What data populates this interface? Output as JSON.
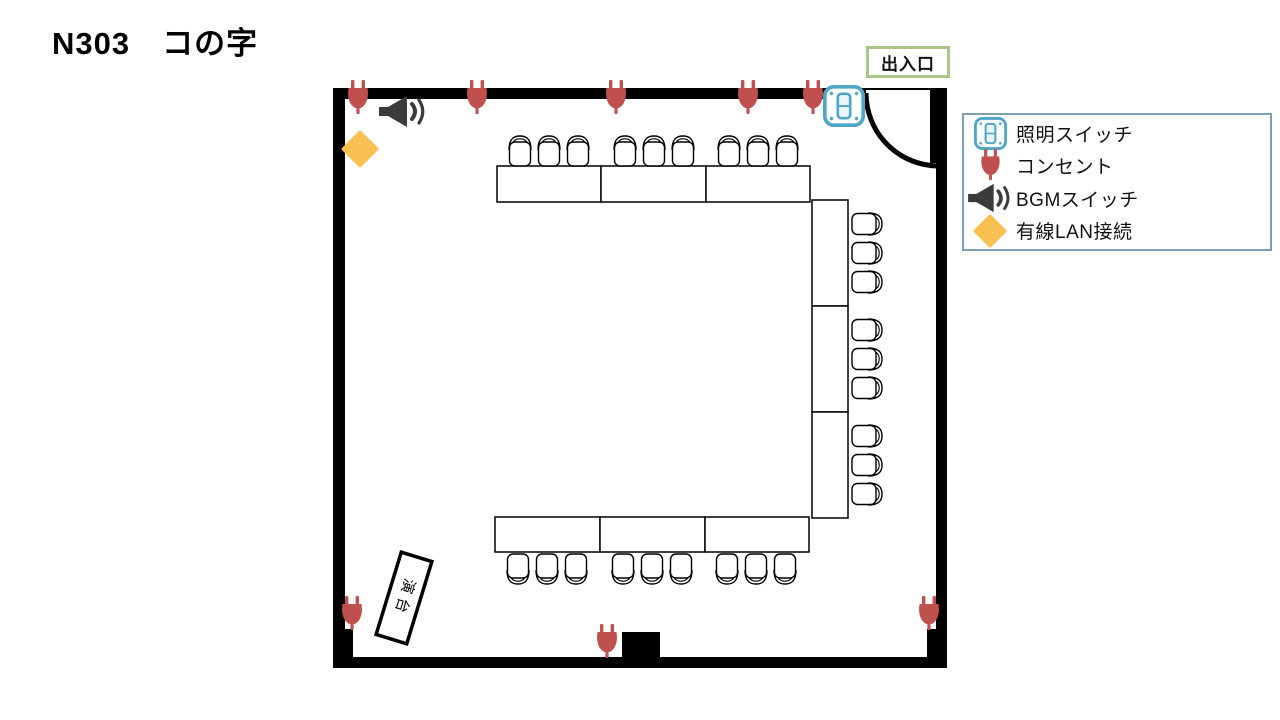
{
  "title": "N303　コの字",
  "door": {
    "label": "出入口"
  },
  "podium": {
    "label": "演台"
  },
  "legend": {
    "items": [
      {
        "icon": "light-switch-icon",
        "label": "照明スイッチ"
      },
      {
        "icon": "outlet-icon",
        "label": "コンセント"
      },
      {
        "icon": "bgm-switch-icon",
        "label": "BGMスイッチ"
      },
      {
        "icon": "wired-lan-icon",
        "label": "有線LAN接続"
      }
    ]
  },
  "colors": {
    "wall": "#000000",
    "outlet_red": "#C0504D",
    "lan_yellow": "#F8C050",
    "switch_blue": "#4FA6C6",
    "speaker_gray": "#3B3B3B",
    "legend_border": "#7C9FB5",
    "entrance_border": "#A9C687"
  },
  "plan": {
    "tables": [
      {
        "x": 497,
        "y": 166,
        "w": 104,
        "h": 36
      },
      {
        "x": 601,
        "y": 166,
        "w": 105,
        "h": 36
      },
      {
        "x": 706,
        "y": 166,
        "w": 104,
        "h": 36
      },
      {
        "x": 812,
        "y": 200,
        "w": 36,
        "h": 106
      },
      {
        "x": 812,
        "y": 306,
        "w": 36,
        "h": 106
      },
      {
        "x": 812,
        "y": 412,
        "w": 36,
        "h": 106
      },
      {
        "x": 495,
        "y": 517,
        "w": 105,
        "h": 35
      },
      {
        "x": 600,
        "y": 517,
        "w": 105,
        "h": 35
      },
      {
        "x": 705,
        "y": 517,
        "w": 104,
        "h": 35
      }
    ],
    "chairs": [
      {
        "x": 506,
        "y": 134,
        "rot": 0
      },
      {
        "x": 535,
        "y": 134,
        "rot": 0
      },
      {
        "x": 564,
        "y": 134,
        "rot": 0
      },
      {
        "x": 611,
        "y": 134,
        "rot": 0
      },
      {
        "x": 640,
        "y": 134,
        "rot": 0
      },
      {
        "x": 669,
        "y": 134,
        "rot": 0
      },
      {
        "x": 715,
        "y": 134,
        "rot": 0
      },
      {
        "x": 744,
        "y": 134,
        "rot": 0
      },
      {
        "x": 773,
        "y": 134,
        "rot": 0
      },
      {
        "x": 853,
        "y": 207,
        "rot": 90
      },
      {
        "x": 853,
        "y": 236,
        "rot": 90
      },
      {
        "x": 853,
        "y": 265,
        "rot": 90
      },
      {
        "x": 853,
        "y": 313,
        "rot": 90
      },
      {
        "x": 853,
        "y": 342,
        "rot": 90
      },
      {
        "x": 853,
        "y": 371,
        "rot": 90
      },
      {
        "x": 853,
        "y": 419,
        "rot": 90
      },
      {
        "x": 853,
        "y": 448,
        "rot": 90
      },
      {
        "x": 853,
        "y": 477,
        "rot": 90
      },
      {
        "x": 504,
        "y": 552,
        "rot": 180
      },
      {
        "x": 533,
        "y": 552,
        "rot": 180
      },
      {
        "x": 562,
        "y": 552,
        "rot": 180
      },
      {
        "x": 609,
        "y": 552,
        "rot": 180
      },
      {
        "x": 638,
        "y": 552,
        "rot": 180
      },
      {
        "x": 667,
        "y": 552,
        "rot": 180
      },
      {
        "x": 713,
        "y": 552,
        "rot": 180
      },
      {
        "x": 742,
        "y": 552,
        "rot": 180
      },
      {
        "x": 771,
        "y": 552,
        "rot": 180
      }
    ],
    "outlets": [
      {
        "x": 346,
        "y": 80
      },
      {
        "x": 465,
        "y": 80
      },
      {
        "x": 604,
        "y": 80
      },
      {
        "x": 736,
        "y": 80
      },
      {
        "x": 801,
        "y": 80
      },
      {
        "x": 340,
        "y": 596
      },
      {
        "x": 917,
        "y": 596
      },
      {
        "x": 595,
        "y": 624
      }
    ]
  }
}
